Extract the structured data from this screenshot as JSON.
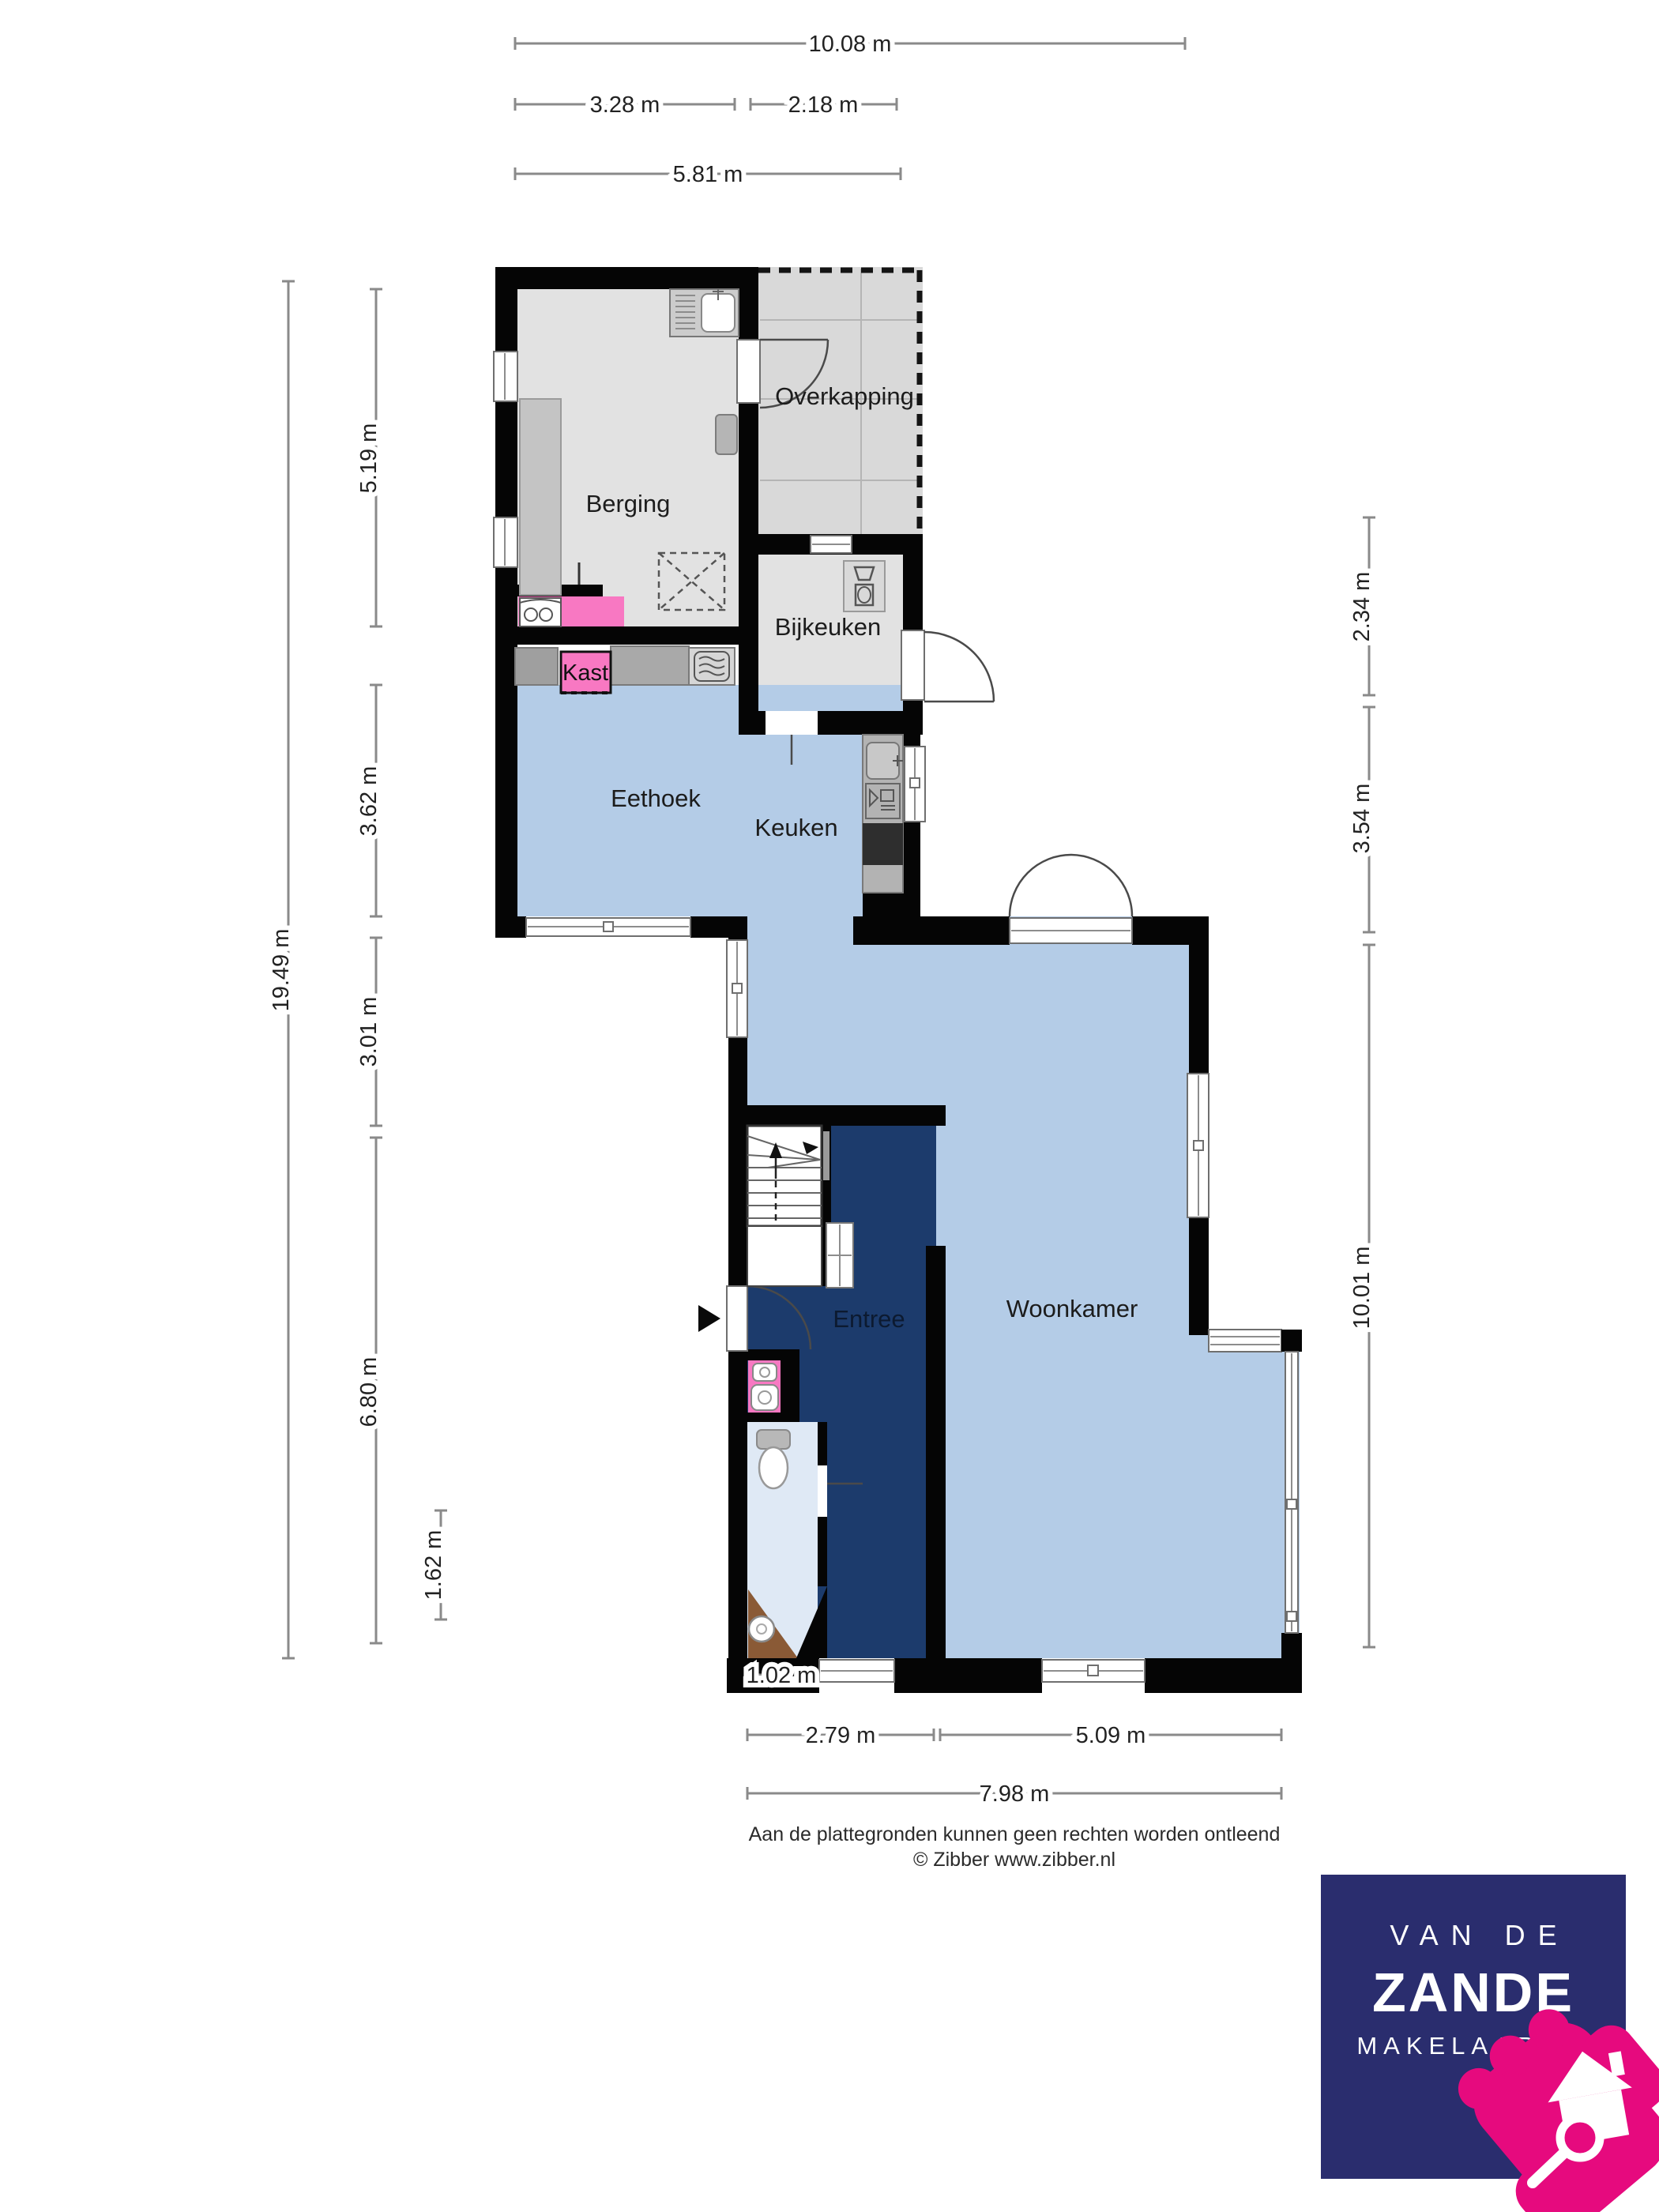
{
  "rooms": {
    "berging": {
      "label": "Berging"
    },
    "overkapping": {
      "label": "Overkapping"
    },
    "bijkeuken": {
      "label": "Bijkeuken"
    },
    "eethoek": {
      "label": "Eethoek"
    },
    "keuken": {
      "label": "Keuken"
    },
    "woonkamer": {
      "label": "Woonkamer"
    },
    "entree": {
      "label": "Entree"
    },
    "kast": {
      "label": "Kast"
    }
  },
  "dimensions": {
    "top": [
      {
        "label": "10.08 m"
      },
      {
        "label": "3.28 m"
      },
      {
        "label": "2.18 m"
      },
      {
        "label": "5.81 m"
      }
    ],
    "left": [
      {
        "label": "19.49 m"
      },
      {
        "label": "5.19 m"
      },
      {
        "label": "3.62 m"
      },
      {
        "label": "3.01 m"
      },
      {
        "label": "6.80 m"
      },
      {
        "label": "1.62 m"
      }
    ],
    "right": [
      {
        "label": "2.34 m"
      },
      {
        "label": "3.54 m"
      },
      {
        "label": "10.01 m"
      }
    ],
    "bottom": [
      {
        "label": "1.02 m"
      },
      {
        "label": "2.79 m"
      },
      {
        "label": "5.09 m"
      },
      {
        "label": "7.98 m"
      }
    ]
  },
  "footer": {
    "disclaimer": "Aan de plattegronden kunnen geen rechten worden ontleend",
    "credit": "© Zibber www.zibber.nl"
  },
  "logo": {
    "line1": "VAN DE",
    "line2": "ZANDE",
    "line3": "MAKELAARDIJ"
  },
  "icons": {
    "fixtures": [
      "sink-icon",
      "washing-machine-icon",
      "dryer-icon",
      "dishwasher-icon",
      "stove-icon",
      "microwave-icon",
      "toilet-icon",
      "washbasin-icon",
      "stairs-up-arrow-icon",
      "entrance-arrow-icon",
      "house-magnifier-icon"
    ]
  },
  "colors": {
    "floor_blue": "#b4cce7",
    "floor_gray": "#e2e2e2",
    "overkapping_gray": "#d9d9d9",
    "entree_navy": "#1c3b6c",
    "toilet_floor": "#dfe9f5",
    "wood_brown": "#8a5a36",
    "accent_pink": "#f878c2",
    "counter_gray": "#a9a9a9",
    "logo_navy": "#2a2d6e",
    "logo_pink": "#e60a7e"
  }
}
